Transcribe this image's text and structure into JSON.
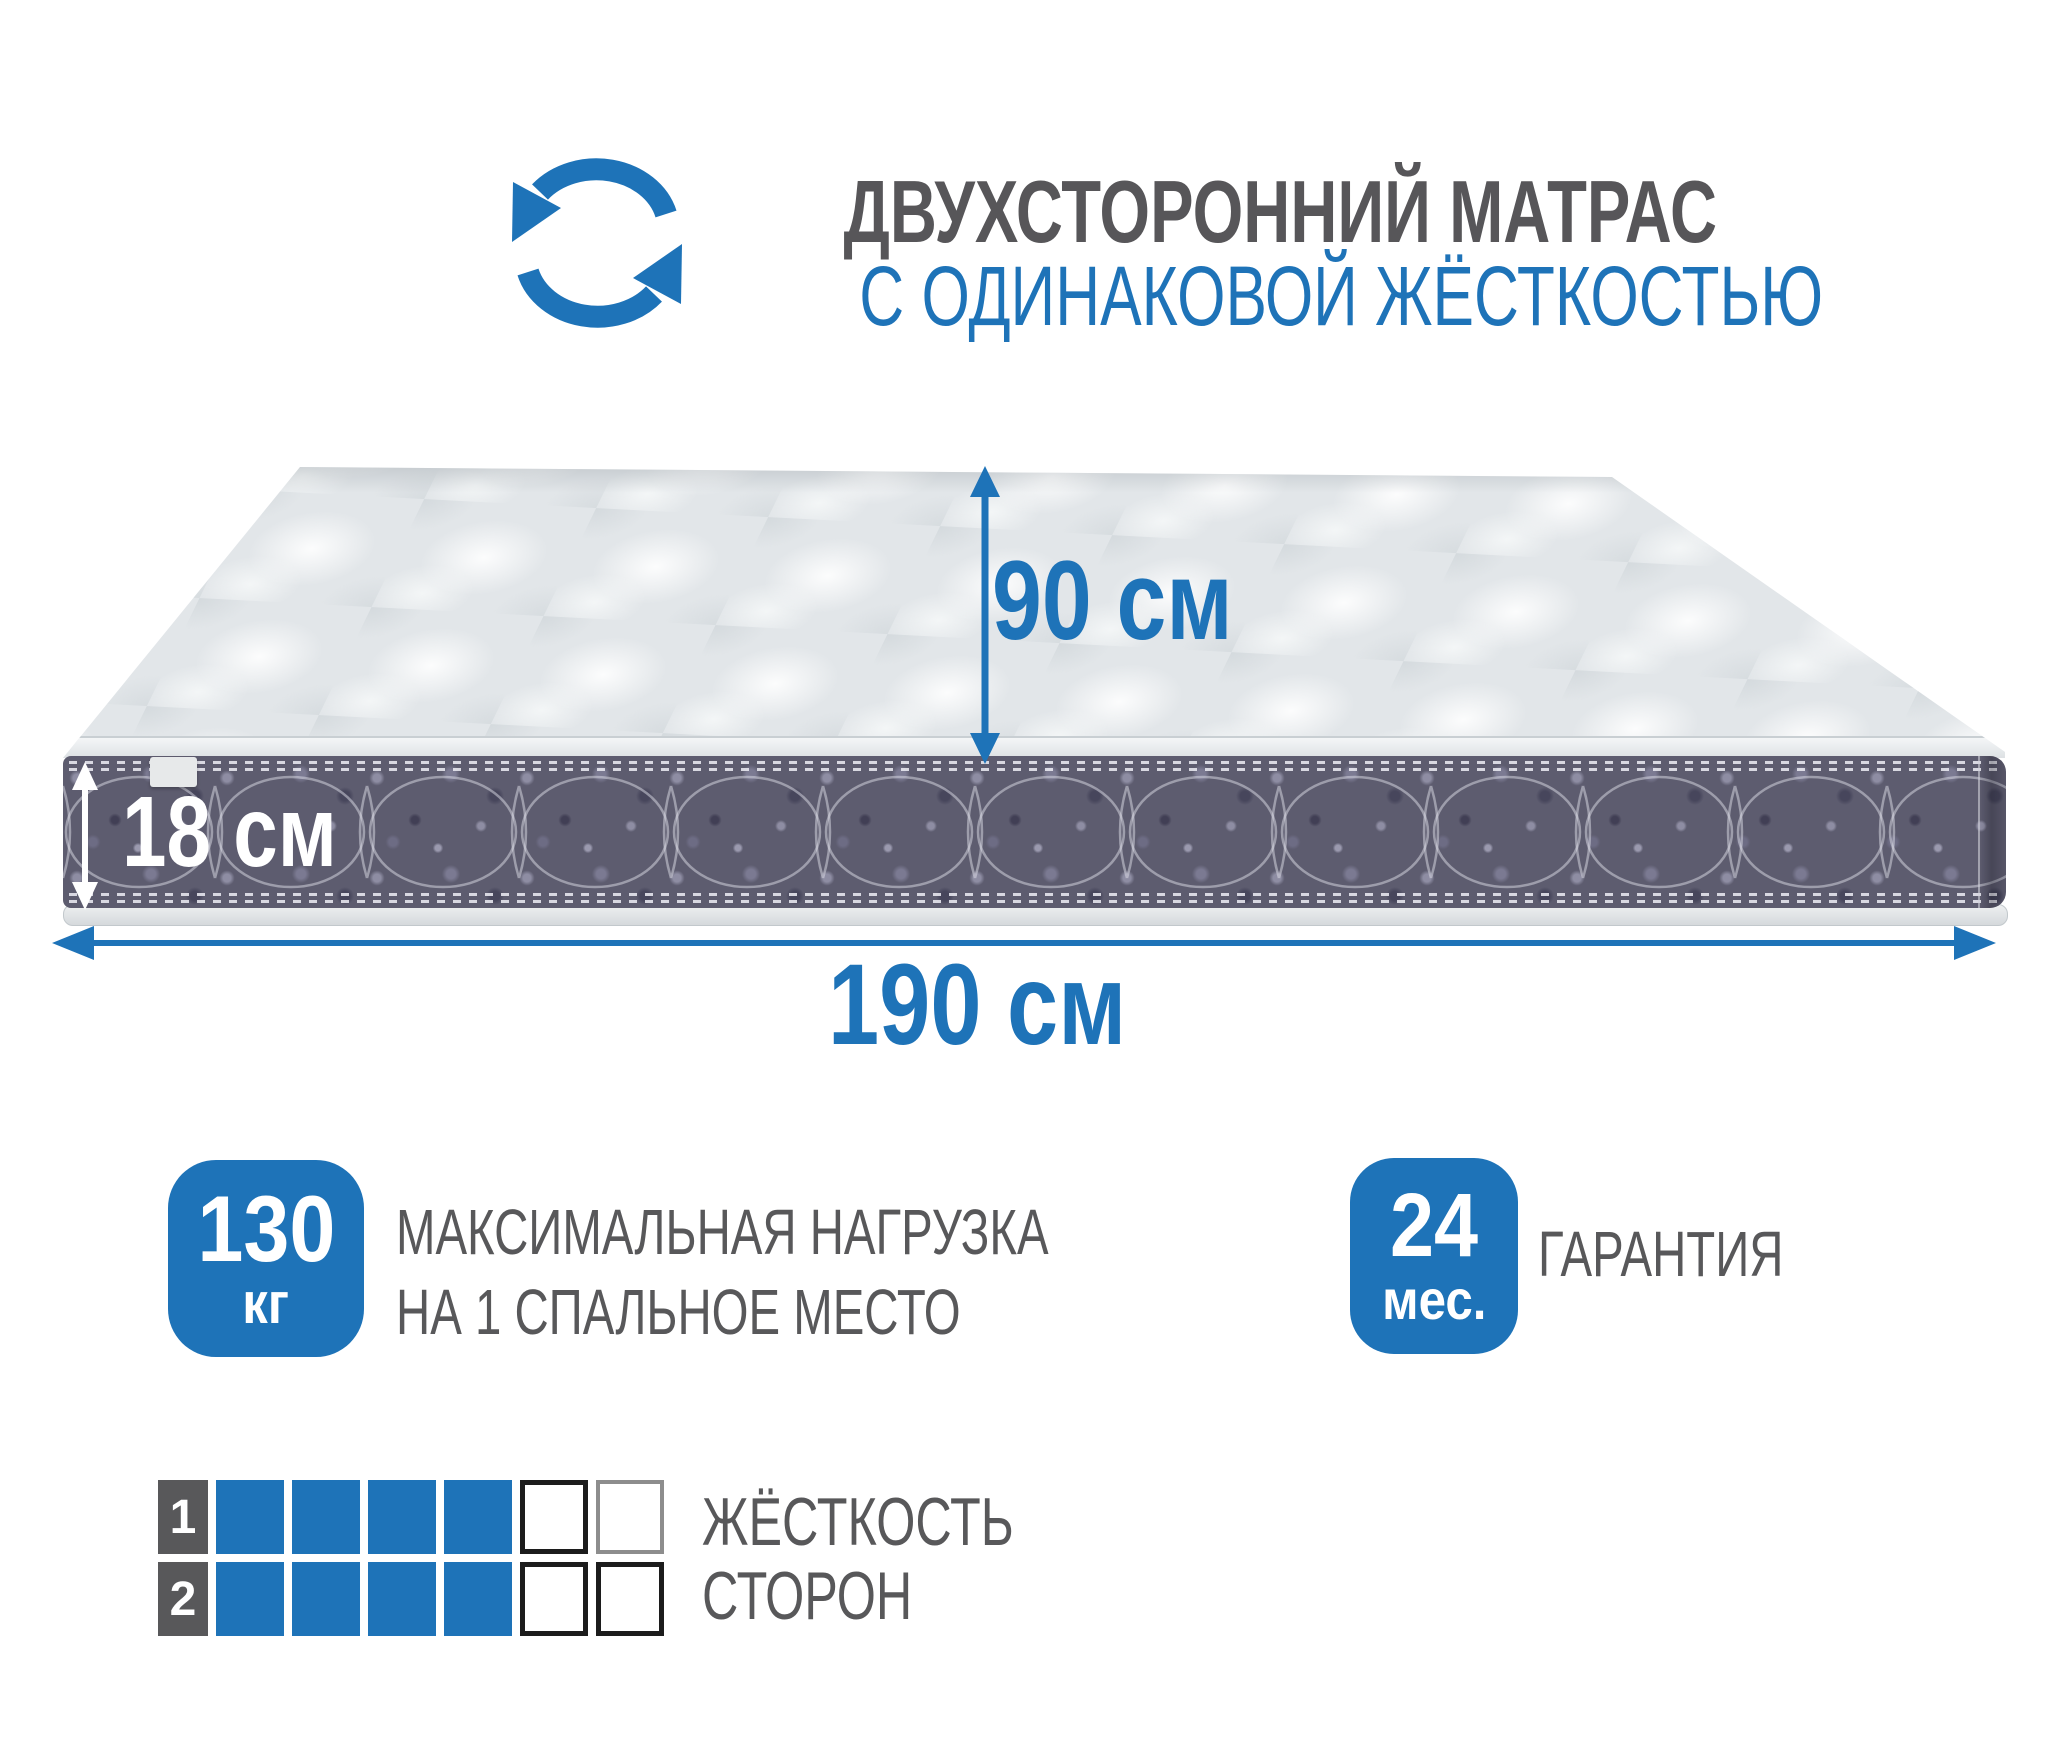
{
  "header": {
    "icon": "rotate-arrows-icon",
    "title_line1": "ДВУХСТОРОННИЙ МАТРАС",
    "title_line2": "С ОДИНАКОВОЙ ЖЁСТКОСТЬЮ"
  },
  "mattress": {
    "depth_label": "90 см",
    "thickness_label": "18 см",
    "length_label": "190 см"
  },
  "badges": {
    "max_load": {
      "value": "130",
      "unit": "кг",
      "line1": "МАКСИМАЛЬНАЯ НАГРУЗКА",
      "line2": "НА 1 СПАЛЬНОЕ МЕСТО"
    },
    "warranty": {
      "value": "24",
      "unit": "мес.",
      "label": "ГАРАНТИЯ"
    }
  },
  "firmness": {
    "label_line1": "ЖЁСТКОСТЬ",
    "label_line2": "СТОРОН",
    "scale_max": 6,
    "rows": [
      {
        "number": "1",
        "filled": 4
      },
      {
        "number": "2",
        "filled": 4
      }
    ]
  },
  "colors": {
    "accent_blue": "#1e73b8",
    "text_gray": "#58585a",
    "title_gray": "#575659",
    "side_dark": "#5d5c6f",
    "top_light": "#e2e6e9"
  }
}
